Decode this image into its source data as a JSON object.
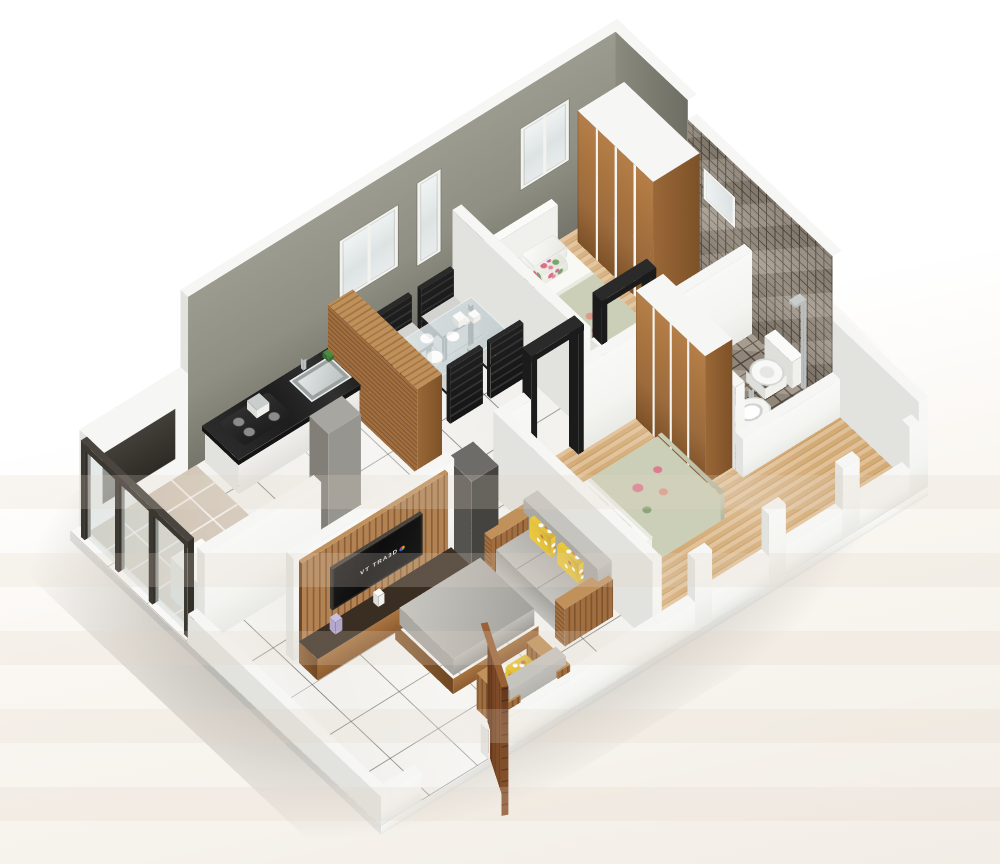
{
  "scene": {
    "kind": "3d-isometric-floor-plan-render",
    "rooms_depicted": [
      "living-room",
      "dining",
      "kitchen",
      "utility-balcony",
      "bedroom-1",
      "bedroom-2",
      "bathroom"
    ]
  },
  "tv": {
    "logo_text": "VT TRA3D"
  },
  "palette": {
    "background": "#ffffff",
    "background_warm": "#f2ede6",
    "shadow": "#8d887f",
    "wall_gray": "#8f8f83",
    "wall_gray_deep": "#75756b",
    "wall_gray_top": "#f6f6f4",
    "white_wall": "#f4f4f1",
    "white_wall_side": "#e2e2de",
    "tile": "#f1f0ec",
    "tile_line": "#3f3f3a",
    "wood_floor_light": "#e0c096",
    "wood_floor_dark": "#c69a62",
    "balcony_tile": "#d6cbbc",
    "mosaic": "#9c9183",
    "mosaic_grout": "#564b40",
    "granite": "#1d1d1d",
    "furniture_wood": "#a9743f",
    "furniture_wood_dark": "#7d5127",
    "sofa_gray": "#b6b4af",
    "pillow_yellow": "#e2c23d",
    "bedding_white": "#f4f4f1",
    "bedding_sage": "#cbcfb8",
    "door_wood": "#7c4a27",
    "frame_black": "#1b1b1b",
    "plant_green": "#2f6b35",
    "steel": "#c9cdcc",
    "glass": "#dfe5e4",
    "tv_black": "#0e0e0e"
  }
}
